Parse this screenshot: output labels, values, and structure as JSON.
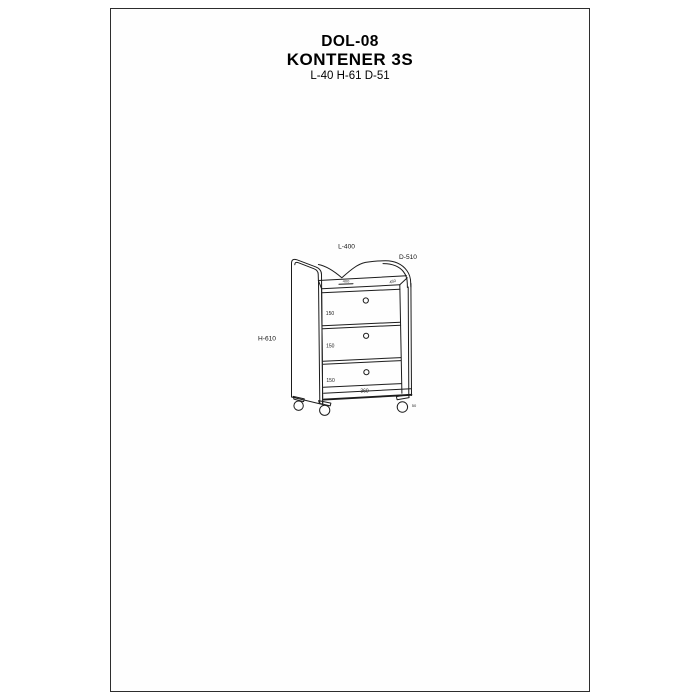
{
  "page": {
    "product_code": "DOL-08",
    "product_name": "KONTENER 3S",
    "dimensions_summary": "L-40 H-61 D-51"
  },
  "drawing": {
    "dim_width": "L-400",
    "dim_depth": "D-510",
    "dim_height": "H-610",
    "drawer_heights": [
      "150",
      "150",
      "150"
    ],
    "front_width": "360",
    "top_width": "400",
    "top_depth": "450",
    "caster_height": "50"
  },
  "colors": {
    "line": "#1c1c1c",
    "background": "#ffffff",
    "frame": "#2d2d2d"
  }
}
